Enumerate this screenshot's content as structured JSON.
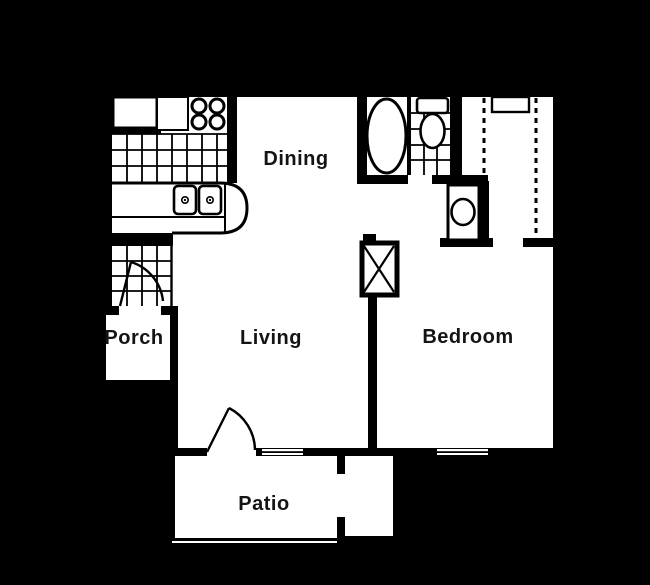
{
  "title": "One-bedroom apartment floor plan",
  "colors": {
    "background": "#000000",
    "floor": "#ffffff",
    "wall": "#000000",
    "label": "#141414"
  },
  "rooms": {
    "dining": {
      "label": "Dining"
    },
    "porch": {
      "label": "Porch"
    },
    "living": {
      "label": "Living"
    },
    "bedroom": {
      "label": "Bedroom"
    },
    "patio": {
      "label": "Patio"
    }
  },
  "fixtures": [
    "refrigerator",
    "range-burners",
    "kitchen-counter-double-sink",
    "kitchen-tile-floor",
    "entry-tile-floor",
    "entry-door-swing",
    "bathtub",
    "toilet",
    "bathroom-tile-floor",
    "vanity-sink",
    "walk-in-closet-rod-left",
    "walk-in-closet-rod-right",
    "closet-shelf",
    "water-heater-closet",
    "patio-door-swing",
    "living-window",
    "bedroom-window",
    "patio-storage-closet"
  ]
}
